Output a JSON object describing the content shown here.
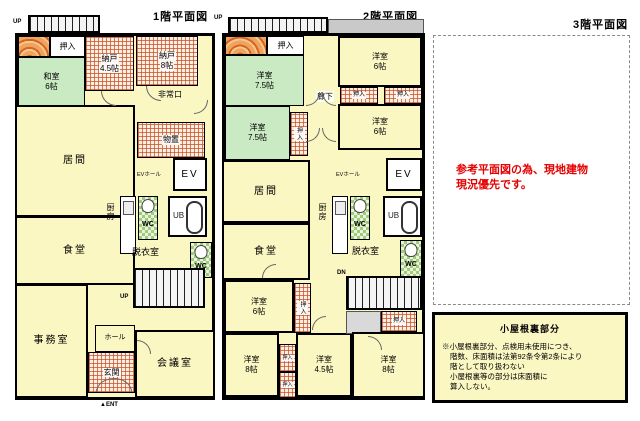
{
  "colors": {
    "room_yellow": "#FBF7C3",
    "room_green": "#C9EAC2",
    "hatch_orange": "#C85028",
    "wc_checker_green": "#9FCB7B",
    "wall_black": "#000000",
    "note_red": "#E60000",
    "gray_strip": "#C9C9C9"
  },
  "floor1": {
    "title": "1階平面図",
    "stair_up_label": "UP",
    "inner_stair_up_label": "UP",
    "ent_label": "▲ENT",
    "rooms": {
      "oshiire_top": {
        "label": "押入"
      },
      "washitsu": {
        "label": "和室",
        "size": "6帖"
      },
      "nando45": {
        "label": "納戸",
        "size": "4.5帖"
      },
      "nando8": {
        "label": "納戸",
        "size": "8帖"
      },
      "hijoguchi": {
        "label": "非常口"
      },
      "monooki": {
        "label": "物置"
      },
      "ima": {
        "label": "居間"
      },
      "ev_hall": {
        "label": "EVホール"
      },
      "ev": {
        "label": "EV"
      },
      "chubo": {
        "label": "厨房"
      },
      "wc_a": {
        "label": "WC"
      },
      "ub": {
        "label": "UB"
      },
      "datsuishitsu": {
        "label": "脱衣室"
      },
      "wc_b": {
        "label": "WC"
      },
      "shokudo": {
        "label": "食堂"
      },
      "jimushitsu": {
        "label": "事務室"
      },
      "hall": {
        "label": "ホール"
      },
      "genkan": {
        "label": "玄関"
      },
      "kaigishitsu": {
        "label": "会議室"
      }
    }
  },
  "floor2": {
    "title": "2階平面図",
    "stair_up_label": "UP",
    "stair_dn_label": "DN",
    "rooms": {
      "oshiire_top": {
        "label": "押入"
      },
      "yoshitsu75_a": {
        "label": "洋室",
        "size": "7.5帖"
      },
      "rouka": {
        "label": "廊下"
      },
      "yoshitsu6_a": {
        "label": "洋室",
        "size": "6帖"
      },
      "oshiire_pair_l": {
        "label": "押入"
      },
      "oshiire_pair_r": {
        "label": "押入"
      },
      "yoshitsu75_b": {
        "label": "洋室",
        "size": "7.5帖"
      },
      "oshiire_v": {
        "label": "押入"
      },
      "yoshitsu6_b": {
        "label": "洋室",
        "size": "6帖"
      },
      "ev_hall": {
        "label": "EVホール"
      },
      "ev": {
        "label": "EV"
      },
      "ima": {
        "label": "居間"
      },
      "chubo": {
        "label": "厨房"
      },
      "wc_a": {
        "label": "WC"
      },
      "ub": {
        "label": "UB"
      },
      "datsuishitsu": {
        "label": "脱衣室"
      },
      "wc_b": {
        "label": "WC"
      },
      "shokudo": {
        "label": "食堂"
      },
      "yoshitsu6_c": {
        "label": "洋室",
        "size": "6帖"
      },
      "oshiire_v2": {
        "label": "押入"
      },
      "yoshitsu8_a": {
        "label": "洋室",
        "size": "8帖"
      },
      "oshiire_s1": {
        "label": "押入"
      },
      "oshiire_s2": {
        "label": "押入"
      },
      "yoshitsu45": {
        "label": "洋室",
        "size": "4.5帖"
      },
      "oshiire_br": {
        "label": "押入"
      },
      "yoshitsu8_b": {
        "label": "洋室",
        "size": "8帖"
      }
    }
  },
  "floor3": {
    "title": "3階平面図",
    "red_note_line1": "参考平面図の為、現地建物",
    "red_note_line2": "現況優先です。",
    "attic": {
      "title": "小屋根裏部分",
      "note_line1": "※小屋根裏部分、点検用未使用につき、",
      "note_line2": "階数、床面積は法第92条令第2条により",
      "note_line3": "階として取り扱わない",
      "note_line4": "小屋根裏等の部分は床面積に",
      "note_line5": "算入しない。"
    }
  }
}
